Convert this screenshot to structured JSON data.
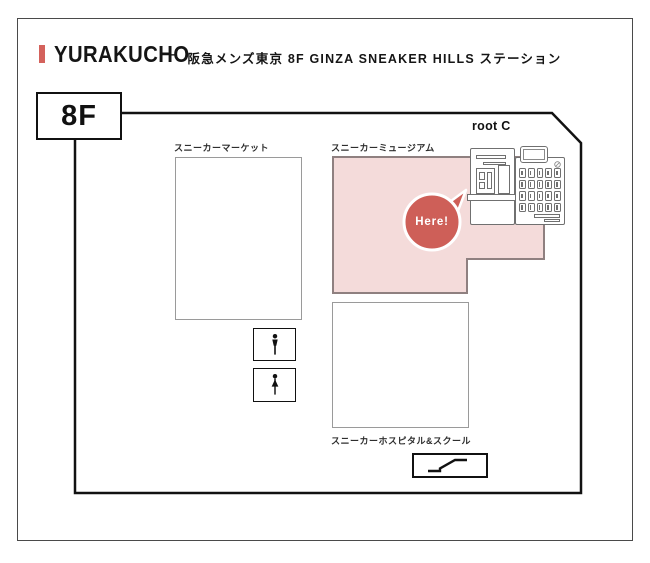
{
  "header": {
    "accent_color": "#d4625c",
    "station": "YURAKUCHO",
    "separator": "−",
    "location": "阪急メンズ東京 8F GINZA SNEAKER HILLS ステーション"
  },
  "floor": {
    "label": "8F"
  },
  "map": {
    "root_label": "root C",
    "marker": {
      "label": "Here!",
      "color": "#ce5f58"
    },
    "areas": {
      "market": {
        "label": "スニーカーマーケット"
      },
      "museum": {
        "label": "スニーカーミュージアム",
        "fill": "#f4dbda",
        "border": "#8f8080"
      },
      "hospital": {
        "label": "スニーカーホスピタル&スクール"
      }
    },
    "icons": {
      "mens_restroom": "mens-restroom-icon",
      "womens_restroom": "womens-restroom-icon",
      "escalator": "escalator-icon",
      "kiosk": "ticket-kiosk-icon",
      "lockers": "locker-bank-icon"
    }
  }
}
